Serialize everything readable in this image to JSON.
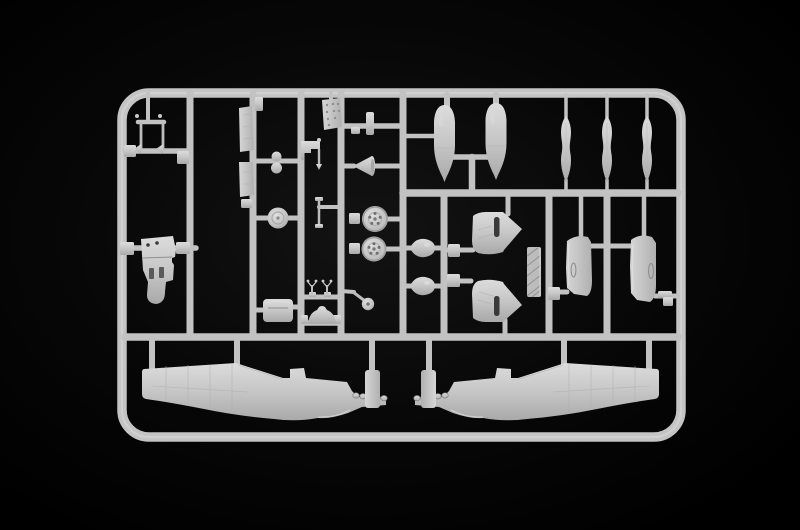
{
  "scene": {
    "type": "photograph",
    "subject": "grey injection-molded plastic model sprue with aircraft parts on black background",
    "background_color": "#000000",
    "vignette_color": "#121212",
    "plastic_color": "#c4c4c4",
    "plastic_light": "#dadada",
    "plastic_dark": "#9a9a9a",
    "runner_color": "#c2c2c2",
    "slot_color": "#3a3a3a"
  },
  "sprue": {
    "frame": {
      "x": 122,
      "y": 93,
      "width": 559,
      "height": 344,
      "rx": 27,
      "thickness": 9.5,
      "highlight_thickness": 2.2
    },
    "runners": [
      {
        "name": "runner-v2",
        "x1": 190,
        "y1": 93,
        "x2": 190,
        "y2": 337,
        "w": 7
      },
      {
        "name": "runner-v3",
        "x1": 253,
        "y1": 93,
        "x2": 253,
        "y2": 337,
        "w": 7
      },
      {
        "name": "runner-v4",
        "x1": 301,
        "y1": 93,
        "x2": 301,
        "y2": 337,
        "w": 7
      },
      {
        "name": "runner-v5",
        "x1": 341,
        "y1": 93,
        "x2": 341,
        "y2": 337,
        "w": 7
      },
      {
        "name": "runner-v6",
        "x1": 403,
        "y1": 93,
        "x2": 403,
        "y2": 337,
        "w": 7
      },
      {
        "name": "runner-v7",
        "x1": 444,
        "y1": 193,
        "x2": 444,
        "y2": 337,
        "w": 7
      },
      {
        "name": "runner-v8",
        "x1": 549,
        "y1": 193,
        "x2": 549,
        "y2": 337,
        "w": 7
      },
      {
        "name": "runner-v9",
        "x1": 607,
        "y1": 193,
        "x2": 607,
        "y2": 337,
        "w": 7
      },
      {
        "name": "runner-h-mid",
        "x1": 403,
        "y1": 193,
        "x2": 678,
        "y2": 193,
        "w": 7.5
      },
      {
        "name": "runner-h-main",
        "x1": 125,
        "y1": 337,
        "x2": 678,
        "y2": 337,
        "w": 7.5
      },
      {
        "name": "gear-stem",
        "x1": 148,
        "y1": 93,
        "x2": 148,
        "y2": 122,
        "w": 4
      },
      {
        "name": "gear-crossbar",
        "x1": 125,
        "y1": 151,
        "x2": 190,
        "y2": 151,
        "w": 5.5
      },
      {
        "name": "bulkhead-crossbar",
        "x1": 125,
        "y1": 248,
        "x2": 196,
        "y2": 248,
        "w": 5.5
      },
      {
        "name": "peanut-crossbar",
        "x1": 253,
        "y1": 161,
        "x2": 301,
        "y2": 161,
        "w": 5
      },
      {
        "name": "disc-crossbar",
        "x1": 253,
        "y1": 218,
        "x2": 301,
        "y2": 218,
        "w": 5
      },
      {
        "name": "box-stub-left",
        "x1": 253,
        "y1": 310,
        "x2": 264,
        "y2": 310,
        "w": 5
      },
      {
        "name": "box-stub-right",
        "x1": 290,
        "y1": 307,
        "x2": 301,
        "y2": 307,
        "w": 5
      },
      {
        "name": "levers-crossbar",
        "x1": 301,
        "y1": 297,
        "x2": 341,
        "y2": 297,
        "w": 5
      },
      {
        "name": "headrest-crossbar",
        "x1": 301,
        "y1": 323,
        "x2": 341,
        "y2": 323,
        "w": 5.5
      },
      {
        "name": "mast-arm",
        "x1": 319,
        "y1": 207,
        "x2": 341,
        "y2": 207,
        "w": 4
      },
      {
        "name": "tee-crossbar",
        "x1": 341,
        "y1": 126,
        "x2": 403,
        "y2": 126,
        "w": 5.5
      },
      {
        "name": "panel-stem",
        "x1": 331,
        "y1": 93,
        "x2": 331,
        "y2": 101,
        "w": 4
      },
      {
        "name": "spinner-stub-left",
        "x1": 341,
        "y1": 166,
        "x2": 354,
        "y2": 166,
        "w": 5
      },
      {
        "name": "spinner-stub-right",
        "x1": 373,
        "y1": 166,
        "x2": 403,
        "y2": 166,
        "w": 5
      },
      {
        "name": "wheel1-stub",
        "x1": 386,
        "y1": 219,
        "x2": 403,
        "y2": 219,
        "w": 5
      },
      {
        "name": "wheel2-stub",
        "x1": 385,
        "y1": 249,
        "x2": 403,
        "y2": 249,
        "w": 5
      },
      {
        "name": "tailwheel-arm",
        "x1": 341,
        "y1": 291,
        "x2": 354,
        "y2": 292,
        "w": 4
      },
      {
        "name": "fairing1-stub-left",
        "x1": 403,
        "y1": 248,
        "x2": 413,
        "y2": 248,
        "w": 5
      },
      {
        "name": "fairing1-stub-right",
        "x1": 433,
        "y1": 248,
        "x2": 444,
        "y2": 248,
        "w": 5
      },
      {
        "name": "fairing2-stub-left",
        "x1": 403,
        "y1": 286,
        "x2": 412,
        "y2": 286,
        "w": 5
      },
      {
        "name": "fairing2-stub-right",
        "x1": 433,
        "y1": 286,
        "x2": 444,
        "y2": 286,
        "w": 5
      },
      {
        "name": "wedge1-stub",
        "x1": 444,
        "y1": 250,
        "x2": 473,
        "y2": 250,
        "w": 5
      },
      {
        "name": "wedge1-stem",
        "x1": 508,
        "y1": 193,
        "x2": 508,
        "y2": 214,
        "w": 5
      },
      {
        "name": "wedge2-stub",
        "x1": 444,
        "y1": 281,
        "x2": 471,
        "y2": 281,
        "w": 5
      },
      {
        "name": "wedge2-stem",
        "x1": 505,
        "y1": 320,
        "x2": 505,
        "y2": 337,
        "w": 5
      },
      {
        "name": "cowl1-arm",
        "x1": 549,
        "y1": 292,
        "x2": 567,
        "y2": 292,
        "w": 5
      },
      {
        "name": "cowl1-stem",
        "x1": 581,
        "y1": 193,
        "x2": 581,
        "y2": 240,
        "w": 4.5
      },
      {
        "name": "cowl1-stub",
        "x1": 591,
        "y1": 246,
        "x2": 607,
        "y2": 246,
        "w": 5
      },
      {
        "name": "cowl2-stub",
        "x1": 607,
        "y1": 246,
        "x2": 633,
        "y2": 246,
        "w": 5
      },
      {
        "name": "cowl2-stem",
        "x1": 644,
        "y1": 193,
        "x2": 644,
        "y2": 240,
        "w": 4.5
      },
      {
        "name": "cowl2-arm",
        "x1": 655,
        "y1": 296,
        "x2": 678,
        "y2": 296,
        "w": 5
      },
      {
        "name": "bomb1-side-stub",
        "x1": 403,
        "y1": 136,
        "x2": 434,
        "y2": 136,
        "w": 4.5
      },
      {
        "name": "bomb1-stem",
        "x1": 447,
        "y1": 95,
        "x2": 447,
        "y2": 107,
        "w": 6
      },
      {
        "name": "bomb2-stem",
        "x1": 496,
        "y1": 95,
        "x2": 496,
        "y2": 105,
        "w": 6
      },
      {
        "name": "bomb-tee-bar",
        "x1": 453,
        "y1": 157,
        "x2": 489,
        "y2": 157,
        "w": 5.5
      },
      {
        "name": "bomb-tee-stem",
        "x1": 472,
        "y1": 157,
        "x2": 472,
        "y2": 193,
        "w": 6.5
      },
      {
        "name": "blade1-stem-top",
        "x1": 566,
        "y1": 95,
        "x2": 566,
        "y2": 118,
        "w": 3.5
      },
      {
        "name": "blade1-stem-bottom",
        "x1": 566,
        "y1": 180,
        "x2": 566,
        "y2": 193,
        "w": 3.5
      },
      {
        "name": "blade2-stem-top",
        "x1": 607,
        "y1": 95,
        "x2": 607,
        "y2": 118,
        "w": 3.5
      },
      {
        "name": "blade2-stem-bottom",
        "x1": 607,
        "y1": 180,
        "x2": 607,
        "y2": 193,
        "w": 3.5
      },
      {
        "name": "blade3-stem-top",
        "x1": 647,
        "y1": 95,
        "x2": 647,
        "y2": 118,
        "w": 3.5
      },
      {
        "name": "blade3-stem-bottom",
        "x1": 647,
        "y1": 180,
        "x2": 647,
        "y2": 193,
        "w": 3.5
      },
      {
        "name": "fuselage-left-stub-1",
        "x1": 152,
        "y1": 337,
        "x2": 152,
        "y2": 368,
        "w": 6
      },
      {
        "name": "fuselage-left-stub-2",
        "x1": 237,
        "y1": 337,
        "x2": 237,
        "y2": 366,
        "w": 6
      },
      {
        "name": "fuselage-left-nose-runner",
        "x1": 372,
        "y1": 337,
        "x2": 372,
        "y2": 376,
        "w": 6
      },
      {
        "name": "fuselage-right-stub-1",
        "x1": 649,
        "y1": 337,
        "x2": 649,
        "y2": 368,
        "w": 6
      },
      {
        "name": "fuselage-right-stub-2",
        "x1": 564,
        "y1": 337,
        "x2": 564,
        "y2": 366,
        "w": 6
      },
      {
        "name": "fuselage-right-nose-runner",
        "x1": 429,
        "y1": 337,
        "x2": 429,
        "y2": 376,
        "w": 6
      }
    ]
  },
  "parts_inventory": [
    {
      "name": "landing-gear-leg",
      "count": 2
    },
    {
      "name": "cockpit-bulkhead",
      "count": 1
    },
    {
      "name": "flat-panel",
      "count": 2
    },
    {
      "name": "linkage-peanut",
      "count": 1
    },
    {
      "name": "hub-disc",
      "count": 1
    },
    {
      "name": "equipment-box",
      "count": 1
    },
    {
      "name": "instrument-panel",
      "count": 1
    },
    {
      "name": "bracket-with-pin",
      "count": 1
    },
    {
      "name": "antenna-mast",
      "count": 1
    },
    {
      "name": "control-lever",
      "count": 2
    },
    {
      "name": "headrest-arch",
      "count": 1
    },
    {
      "name": "tee-fitting",
      "count": 1
    },
    {
      "name": "spinner-cone",
      "count": 1
    },
    {
      "name": "main-wheel",
      "count": 2
    },
    {
      "name": "tail-wheel",
      "count": 1
    },
    {
      "name": "intake-fairing",
      "count": 2
    },
    {
      "name": "exhaust-cowl-panel",
      "count": 2
    },
    {
      "name": "radiator-core",
      "count": 1
    },
    {
      "name": "cowling-half",
      "count": 2
    },
    {
      "name": "retaining-clip",
      "count": 1
    },
    {
      "name": "bomb",
      "count": 2
    },
    {
      "name": "propeller-blade",
      "count": 3
    },
    {
      "name": "fuselage-half",
      "count": 2
    }
  ]
}
